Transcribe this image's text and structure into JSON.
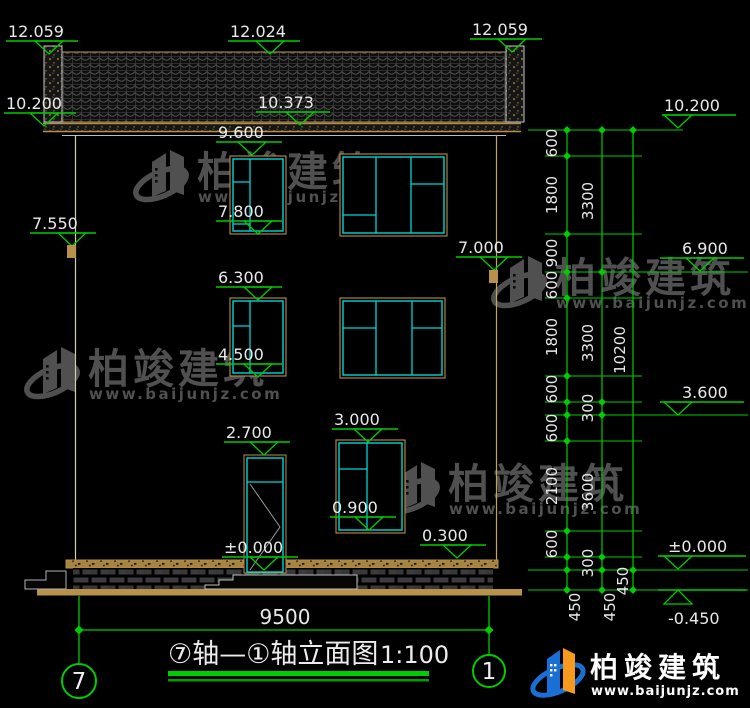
{
  "drawing": {
    "title": "⑦轴—①轴立面图",
    "scale": "1:100",
    "axis_left": "7",
    "axis_right": "1",
    "bottom_width_dim": "9500"
  },
  "watermark": {
    "name": "柏竣建筑",
    "url": "www.baijunjz.com"
  },
  "logo": {
    "name": "柏竣建筑",
    "url": "www.baijunjz.com"
  },
  "colors": {
    "green": "#00cc00",
    "cyan": "#00d6d6",
    "tan": "#b6904c",
    "ground_tan": "#b8924a",
    "text_white": "#e9e9e9",
    "watermark_gray": "#585858",
    "logo_blue": "#1a6fd4",
    "logo_orange": "#f59a1f"
  },
  "watermark_positions": [
    {
      "x": 137,
      "y": 146
    },
    {
      "x": 28,
      "y": 343
    },
    {
      "x": 495,
      "y": 252
    },
    {
      "x": 388,
      "y": 458
    }
  ],
  "elevation_markers": [
    {
      "label": "12.059",
      "tx": 8,
      "ly": 41,
      "x1": 6,
      "x2": 78,
      "ax": 49,
      "dir": "down"
    },
    {
      "label": "12.024",
      "tx": 230,
      "ly": 41,
      "x1": 228,
      "x2": 300,
      "ax": 270,
      "dir": "down"
    },
    {
      "label": "12.059",
      "tx": 472,
      "ly": 39,
      "x1": 470,
      "x2": 542,
      "ax": 512,
      "dir": "down"
    },
    {
      "label": "10.200",
      "tx": 6,
      "ly": 113,
      "x1": 4,
      "x2": 76,
      "ax": 44,
      "dir": "down"
    },
    {
      "label": "10.373",
      "tx": 258,
      "ly": 112,
      "x1": 256,
      "x2": 330,
      "ax": 300,
      "dir": "down"
    },
    {
      "label": "9.600",
      "tx": 218,
      "ly": 142,
      "x1": 216,
      "x2": 282,
      "ax": 252,
      "dir": "down"
    },
    {
      "label": "7.800",
      "tx": 218,
      "ly": 221,
      "x1": 216,
      "x2": 282,
      "ax": 258,
      "dir": "down"
    },
    {
      "label": "7.550",
      "tx": 32,
      "ly": 233,
      "x1": 30,
      "x2": 96,
      "ax": 72,
      "dir": "down"
    },
    {
      "label": "6.300",
      "tx": 218,
      "ly": 287,
      "x1": 216,
      "x2": 282,
      "ax": 258,
      "dir": "down"
    },
    {
      "label": "4.500",
      "tx": 218,
      "ly": 364,
      "x1": 216,
      "x2": 282,
      "ax": 258,
      "dir": "down"
    },
    {
      "label": "7.000",
      "tx": 458,
      "ly": 257,
      "x1": 456,
      "x2": 522,
      "ax": 494,
      "dir": "down"
    },
    {
      "label": "3.000",
      "tx": 334,
      "ly": 429,
      "x1": 332,
      "x2": 398,
      "ax": 368,
      "dir": "down"
    },
    {
      "label": "2.700",
      "tx": 226,
      "ly": 442,
      "x1": 224,
      "x2": 290,
      "ax": 264,
      "dir": "down"
    },
    {
      "label": "0.900",
      "tx": 332,
      "ly": 517,
      "x1": 330,
      "x2": 396,
      "ax": 369,
      "dir": "down"
    },
    {
      "label": "±0.000",
      "tx": 224,
      "ly": 557,
      "x1": 222,
      "x2": 298,
      "ax": 264,
      "dir": "down"
    },
    {
      "label": "0.300",
      "tx": 422,
      "ly": 545,
      "x1": 420,
      "x2": 486,
      "ax": 457,
      "dir": "down"
    },
    {
      "label": "10.200",
      "tx": 664,
      "ly": 115,
      "x1": 662,
      "x2": 736,
      "ax": 678,
      "dir": "down"
    },
    {
      "label": "6.900",
      "tx": 682,
      "ly": 258,
      "x1": 660,
      "x2": 744,
      "ax": 700,
      "dir": "down"
    },
    {
      "label": "3.600",
      "tx": 682,
      "ly": 402,
      "x1": 660,
      "x2": 744,
      "ax": 678,
      "dir": "down"
    },
    {
      "label": "±0.000",
      "tx": 668,
      "ly": 556,
      "x1": 658,
      "x2": 746,
      "ax": 678,
      "dir": "down"
    },
    {
      "label": "-0.450",
      "tx": 668,
      "ly": 590,
      "ty": 624,
      "x1": 658,
      "x2": 746,
      "ax": 678,
      "dir": "up"
    }
  ],
  "level_lines": [
    {
      "y": 130,
      "x1": 528,
      "x2": 683
    },
    {
      "y": 156,
      "x1": 545,
      "x2": 642
    },
    {
      "y": 234,
      "x1": 545,
      "x2": 642
    },
    {
      "y": 272,
      "x1": 545,
      "x2": 748
    },
    {
      "y": 298,
      "x1": 545,
      "x2": 642
    },
    {
      "y": 376,
      "x1": 545,
      "x2": 642
    },
    {
      "y": 402,
      "x1": 545,
      "x2": 642
    },
    {
      "y": 415,
      "x1": 545,
      "x2": 748
    },
    {
      "y": 441,
      "x1": 545,
      "x2": 642
    },
    {
      "y": 531,
      "x1": 545,
      "x2": 642
    },
    {
      "y": 557,
      "x1": 545,
      "x2": 642
    },
    {
      "y": 570,
      "x1": 528,
      "x2": 748
    },
    {
      "y": 590,
      "x1": 528,
      "x2": 748
    }
  ],
  "chain": {
    "vlines": [
      {
        "x": 567,
        "y1": 128,
        "y2": 592
      },
      {
        "x": 602,
        "y1": 128,
        "y2": 592
      },
      {
        "x": 633,
        "y1": 128,
        "y2": 592
      }
    ],
    "tick_ys": {
      "lane1": [
        130,
        156,
        234,
        272,
        298,
        376,
        402,
        415,
        441,
        531,
        557,
        570,
        590
      ],
      "lane2": [
        130,
        272,
        402,
        415,
        557,
        570,
        590
      ],
      "lane3": [
        130,
        570,
        590
      ]
    },
    "lane_x": {
      "lane1": 567,
      "lane2": 602,
      "lane3": 633
    },
    "labels": [
      {
        "text": "600",
        "x": 557,
        "y": 143
      },
      {
        "text": "1800",
        "x": 557,
        "y": 195
      },
      {
        "text": "900",
        "x": 557,
        "y": 253
      },
      {
        "text": "600",
        "x": 557,
        "y": 285
      },
      {
        "text": "1800",
        "x": 557,
        "y": 337
      },
      {
        "text": "600",
        "x": 557,
        "y": 389
      },
      {
        "text": "600",
        "x": 557,
        "y": 428
      },
      {
        "text": "2100",
        "x": 557,
        "y": 486
      },
      {
        "text": "600",
        "x": 557,
        "y": 544
      },
      {
        "text": "3300",
        "x": 593,
        "y": 201
      },
      {
        "text": "3300",
        "x": 593,
        "y": 343
      },
      {
        "text": "300",
        "x": 593,
        "y": 408
      },
      {
        "text": "3600",
        "x": 593,
        "y": 492
      },
      {
        "text": "300",
        "x": 593,
        "y": 563
      },
      {
        "text": "10200",
        "x": 625,
        "y": 350
      },
      {
        "text": "450",
        "x": 580,
        "y": 607
      },
      {
        "text": "450",
        "x": 615,
        "y": 607
      },
      {
        "text": "450",
        "x": 628,
        "y": 581
      }
    ]
  },
  "windows": [
    {
      "x": 230,
      "y": 156,
      "w": 56,
      "h": 78,
      "mullions": [
        250
      ],
      "hdivs": [
        {
          "x1": 233,
          "x2": 250,
          "y": 182
        },
        {
          "x1": 233,
          "x2": 250,
          "y": 224
        }
      ]
    },
    {
      "x": 340,
      "y": 154,
      "w": 107,
      "h": 82,
      "mullions": [
        376,
        411
      ],
      "hdivs": [
        {
          "x1": 343,
          "x2": 376,
          "y": 215
        },
        {
          "x1": 411,
          "x2": 444,
          "y": 184
        }
      ]
    },
    {
      "x": 230,
      "y": 298,
      "w": 56,
      "h": 78,
      "mullions": [
        250
      ],
      "hdivs": [
        {
          "x1": 233,
          "x2": 250,
          "y": 326
        }
      ]
    },
    {
      "x": 340,
      "y": 298,
      "w": 105,
      "h": 80,
      "mullions": [
        376,
        412
      ],
      "hdivs": [
        {
          "x1": 343,
          "x2": 376,
          "y": 328
        },
        {
          "x1": 412,
          "x2": 442,
          "y": 328
        }
      ]
    },
    {
      "x": 336,
      "y": 440,
      "w": 69,
      "h": 93,
      "mullions": [
        367
      ],
      "hdivs": [
        {
          "x1": 339,
          "x2": 367,
          "y": 469
        }
      ]
    }
  ],
  "door": {
    "x": 246,
    "y": 456,
    "w": 38,
    "h": 117,
    "transom_y": 482,
    "diagonals": [
      [
        250,
        484,
        280,
        527
      ],
      [
        280,
        527,
        250,
        570
      ]
    ]
  },
  "wall_ticks": [
    {
      "x": 67,
      "y": 245,
      "w": 9,
      "h": 13
    },
    {
      "x": 489,
      "y": 270,
      "w": 9,
      "h": 13
    }
  ]
}
